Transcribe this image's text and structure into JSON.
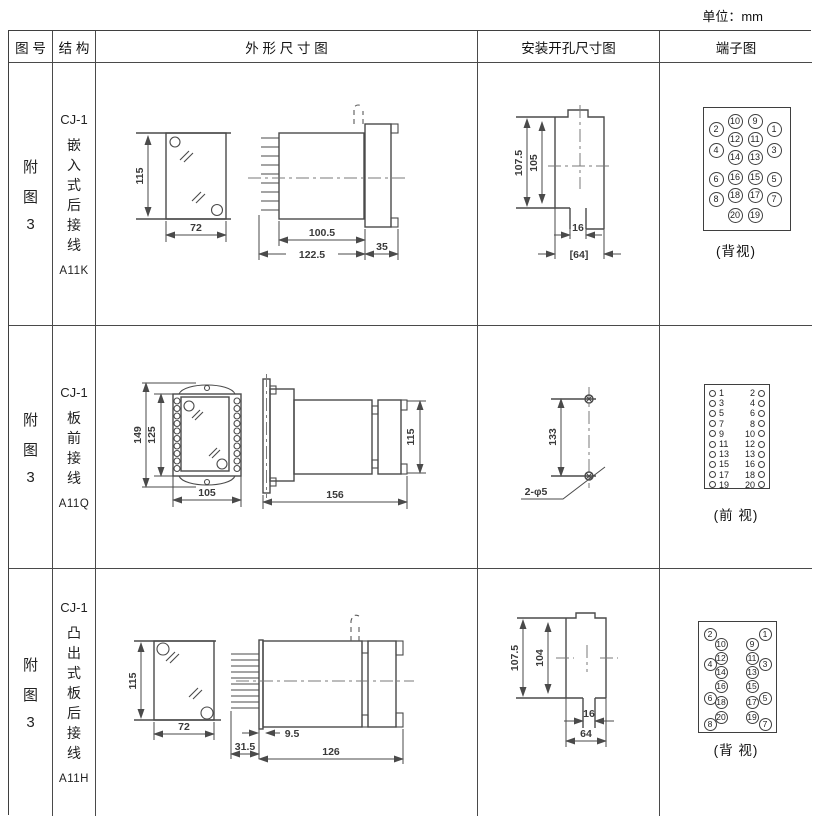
{
  "page": {
    "unit_label": "单位：mm"
  },
  "header": {
    "figure": "图 号",
    "structure": "结 构",
    "outline": "外 形 尺 寸 图",
    "install": "安装开孔尺寸图",
    "terminal": "端子图"
  },
  "rows": [
    {
      "figure_chars": [
        "附",
        "图",
        "3"
      ],
      "model": "CJ-1",
      "structure_chars": [
        "嵌",
        "入",
        "式",
        "后",
        "接",
        "线"
      ],
      "code": "A11K",
      "outline_dims": {
        "height": "115",
        "width": "72",
        "body": "100.5",
        "total": "122.5",
        "flange": "35"
      },
      "install_dims": {
        "outer": "107.5",
        "inner": "105",
        "slot": "16",
        "width": "[64]"
      },
      "terminal": {
        "caption": "(背视)",
        "pins": [
          "2",
          "10",
          "9",
          "1",
          "4",
          "12",
          "11",
          "3",
          "14",
          "13",
          "6",
          "16",
          "15",
          "5",
          "8",
          "18",
          "17",
          "7",
          "20",
          "19"
        ]
      }
    },
    {
      "figure_chars": [
        "附",
        "图",
        "3"
      ],
      "model": "CJ-1",
      "structure_chars": [
        "板",
        "前",
        "接",
        "线"
      ],
      "code": "A11Q",
      "outline_dims": {
        "total_height": "149",
        "height": "125",
        "width": "105",
        "side_height": "115",
        "length": "156"
      },
      "install_dims": {
        "span": "133",
        "holes": "2-φ5"
      },
      "terminal": {
        "caption": "(前 视)",
        "left_numbers": [
          "1",
          "3",
          "5",
          "7",
          "9",
          "11",
          "13",
          "15",
          "17",
          "19"
        ],
        "right_numbers": [
          "2",
          "4",
          "6",
          "8",
          "10",
          "12",
          "13",
          "16",
          "18",
          "20"
        ]
      }
    },
    {
      "figure_chars": [
        "附",
        "图",
        "3"
      ],
      "model": "CJ-1",
      "structure_chars": [
        "凸",
        "出",
        "式",
        "板",
        "后",
        "接",
        "线"
      ],
      "code": "A11H",
      "outline_dims": {
        "height": "115",
        "width": "72",
        "pins": "31.5",
        "offset": "9.5",
        "length": "126"
      },
      "install_dims": {
        "outer": "107.5",
        "inner": "104",
        "slot": "16",
        "width": "64"
      },
      "terminal": {
        "caption": "(背 视)",
        "pins": [
          "2",
          "1",
          "10",
          "9",
          "12",
          "4",
          "11",
          "3",
          "14",
          "13",
          "16",
          "15",
          "6",
          "18",
          "17",
          "5",
          "20",
          "19",
          "8",
          "7"
        ]
      }
    }
  ]
}
